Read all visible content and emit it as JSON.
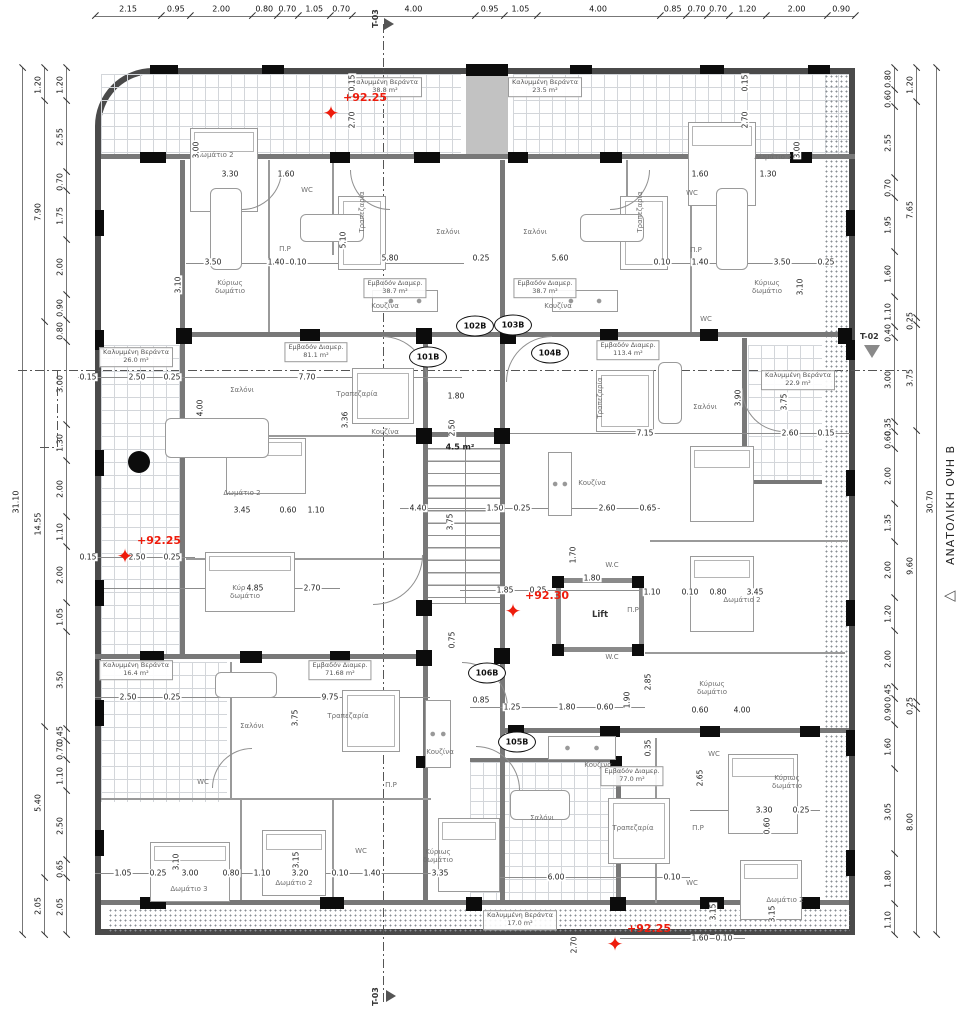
{
  "colors": {
    "elevation_red": "#ee1c0c",
    "wall_gray": "#787878",
    "wall_black": "#0c0c0c",
    "tile_grid": "#d3d6da"
  },
  "side_title": {
    "text": "ΑΝΑΤΟΛΙΚΗ ΟΨΗ Β",
    "triangle": "◁"
  },
  "section_markers": {
    "top": "T-03",
    "bottom": "T-03",
    "right": "T-02"
  },
  "core_labels": {
    "lift": "Lift"
  },
  "dims": {
    "top": [
      "2.15",
      "0.95",
      "2.00",
      "0.80",
      "0.70",
      "1.05",
      "0.70",
      "4.00",
      "0.95",
      "1.05",
      "4.00",
      "0.85",
      "0.70",
      "0.70",
      "1.20",
      "2.00",
      "0.90"
    ],
    "left_total": [
      "31.10"
    ],
    "left_outer": [
      "1.20",
      "7.90",
      "14.55",
      "5.40",
      "2.05"
    ],
    "left_inner": [
      "1.20",
      "2.55",
      "0.70",
      "1.75",
      "2.00",
      "0.90",
      "0.80",
      "3.00",
      "1.30",
      "2.00",
      "1.10",
      "2.00",
      "1.05",
      "3.50",
      "0.45",
      "0.70",
      "1.10",
      "2.50",
      "0.65",
      "2.05"
    ],
    "right_inner": [
      "0.80",
      "0.60",
      "2.55",
      "0.70",
      "1.95",
      "1.60",
      "1.10",
      "0.40",
      "3.00",
      "0.35",
      "0.60",
      "2.00",
      "1.35",
      "2.00",
      "1.20",
      "2.00",
      "0.45",
      "0.90",
      "1.60",
      "3.05",
      "1.80",
      "1.10"
    ],
    "right_outer": [
      "1.20",
      "7.65",
      "0.25",
      "3.75",
      "9.60",
      "0.25",
      "8.00"
    ],
    "right_total": [
      "30.70"
    ]
  },
  "elevation_markers": [
    {
      "label": "+92.25",
      "x": 331,
      "y": 113
    },
    {
      "label": "+92.25",
      "x": 125,
      "y": 556
    },
    {
      "label": "+92.30",
      "x": 513,
      "y": 611
    },
    {
      "label": "+92.25",
      "x": 615,
      "y": 944
    }
  ],
  "unit_tags": [
    {
      "label": "101B",
      "x": 428,
      "y": 357
    },
    {
      "label": "102B",
      "x": 475,
      "y": 326
    },
    {
      "label": "103B",
      "x": 513,
      "y": 325
    },
    {
      "label": "104B",
      "x": 550,
      "y": 353
    },
    {
      "label": "106B",
      "x": 487,
      "y": 673
    },
    {
      "label": "105B",
      "x": 517,
      "y": 742
    }
  ],
  "area_labels": [
    {
      "name": "Καλυμμένη Βεράντα",
      "value": "38.8 m²",
      "x": 385,
      "y": 87
    },
    {
      "name": "Καλυμμένη Βεράντα",
      "value": "23.5 m²",
      "x": 545,
      "y": 87
    },
    {
      "name": "Εμβαδόν Διαμερ.",
      "value": "38.7 m²",
      "x": 395,
      "y": 288
    },
    {
      "name": "Εμβαδόν Διαμερ.",
      "value": "38.7 m²",
      "x": 545,
      "y": 288
    },
    {
      "name": "Εμβαδόν Διαμερ.",
      "value": "81.1 m²",
      "x": 316,
      "y": 352
    },
    {
      "name": "Καλυμμένη Βεράντα",
      "value": "26.0 m²",
      "x": 136,
      "y": 357
    },
    {
      "name": "Εμβαδόν Διαμερ.",
      "value": "113.4 m²",
      "x": 628,
      "y": 350
    },
    {
      "name": "Καλυμμένη Βεράντα",
      "value": "22.9 m²",
      "x": 798,
      "y": 380
    },
    {
      "name": "Καλυμμένη Βεράντα",
      "value": "16.4 m²",
      "x": 136,
      "y": 670
    },
    {
      "name": "Εμβαδόν Διαμερ.",
      "value": "71.68 m²",
      "x": 340,
      "y": 670
    },
    {
      "name": "Εμβαδόν Διαμερ.",
      "value": "77.0 m²",
      "x": 632,
      "y": 776
    },
    {
      "name": "Καλυμμένη Βεράντα",
      "value": "17.0 m²",
      "x": 520,
      "y": 920
    }
  ],
  "room_labels": [
    {
      "t": "Σαλόνι",
      "x": 448,
      "y": 232
    },
    {
      "t": "Σαλόνι",
      "x": 535,
      "y": 232
    },
    {
      "t": "Σαλόνι",
      "x": 242,
      "y": 390
    },
    {
      "t": "Σαλόνι",
      "x": 705,
      "y": 407
    },
    {
      "t": "Σαλόνι",
      "x": 252,
      "y": 726
    },
    {
      "t": "Σαλόνι",
      "x": 542,
      "y": 818
    },
    {
      "t": "Τραπεζαρία",
      "x": 362,
      "y": 212,
      "r": 1
    },
    {
      "t": "Τραπεζαρία",
      "x": 640,
      "y": 212,
      "r": 1
    },
    {
      "t": "Τραπεζαρία",
      "x": 357,
      "y": 394
    },
    {
      "t": "Τραπεζαρία",
      "x": 600,
      "y": 398,
      "r": 1
    },
    {
      "t": "Τραπεζαρία",
      "x": 348,
      "y": 716
    },
    {
      "t": "Τραπεζαρία",
      "x": 633,
      "y": 828
    },
    {
      "t": "Κουζίνα",
      "x": 385,
      "y": 306
    },
    {
      "t": "Κουζίνα",
      "x": 558,
      "y": 306
    },
    {
      "t": "Κουζίνα",
      "x": 385,
      "y": 432
    },
    {
      "t": "Κουζίνα",
      "x": 592,
      "y": 483
    },
    {
      "t": "Κουζίνα",
      "x": 440,
      "y": 752
    },
    {
      "t": "Κουζίνα",
      "x": 598,
      "y": 765
    },
    {
      "t": "WC",
      "x": 307,
      "y": 190
    },
    {
      "t": "WC",
      "x": 692,
      "y": 193
    },
    {
      "t": "WC",
      "x": 706,
      "y": 319
    },
    {
      "t": "W.C",
      "x": 612,
      "y": 565
    },
    {
      "t": "W.C",
      "x": 612,
      "y": 657
    },
    {
      "t": "WC",
      "x": 203,
      "y": 782
    },
    {
      "t": "WC",
      "x": 714,
      "y": 754
    },
    {
      "t": "WC",
      "x": 692,
      "y": 883
    },
    {
      "t": "WC",
      "x": 361,
      "y": 851
    },
    {
      "t": "Π.Ρ",
      "x": 285,
      "y": 249
    },
    {
      "t": "Π.Ρ",
      "x": 696,
      "y": 250
    },
    {
      "t": "Π.Ρ",
      "x": 633,
      "y": 610
    },
    {
      "t": "Π.Ρ",
      "x": 391,
      "y": 785
    },
    {
      "t": "Π.Ρ",
      "x": 698,
      "y": 828
    },
    {
      "t": "Κύριως δωμάτιο",
      "x": 230,
      "y": 287,
      "w": 1
    },
    {
      "t": "Κύριως δωμάτιο",
      "x": 767,
      "y": 287,
      "w": 1
    },
    {
      "t": "Κύριως δωμάτιο",
      "x": 245,
      "y": 592,
      "w": 1
    },
    {
      "t": "Κύριως δωμάτιο",
      "x": 712,
      "y": 688,
      "w": 1
    },
    {
      "t": "Κύριως δωμάτιο",
      "x": 787,
      "y": 782,
      "w": 1
    },
    {
      "t": "Κύριως δωμάτιο",
      "x": 438,
      "y": 856,
      "w": 1
    },
    {
      "t": "Δωμάτιο 2",
      "x": 215,
      "y": 155
    },
    {
      "t": "Δωμάτιο 2",
      "x": 773,
      "y": 157
    },
    {
      "t": "Δωμάτιο 2",
      "x": 242,
      "y": 493
    },
    {
      "t": "Δωμάτιο 2",
      "x": 742,
      "y": 600
    },
    {
      "t": "Δωμάτιο 2",
      "x": 294,
      "y": 883
    },
    {
      "t": "Δωμάτιο 2",
      "x": 785,
      "y": 900
    },
    {
      "t": "Δωμάτιο 3",
      "x": 189,
      "y": 889
    },
    {
      "t": "4.5 m²",
      "x": 460,
      "y": 447,
      "b": 1
    }
  ],
  "dim_texts": [
    [
      "3.30",
      230,
      174
    ],
    [
      "1.60",
      286,
      174
    ],
    [
      "1.60",
      700,
      174
    ],
    [
      "1.30",
      768,
      174
    ],
    [
      "3.00",
      196,
      150,
      1
    ],
    [
      "3.00",
      797,
      150,
      1
    ],
    [
      "2.70",
      352,
      120,
      1
    ],
    [
      "0.15",
      352,
      83,
      1
    ],
    [
      "2.70",
      745,
      120,
      1
    ],
    [
      "0.15",
      745,
      83,
      1
    ],
    [
      "5.10",
      343,
      240,
      1
    ],
    [
      "3.50",
      213,
      262
    ],
    [
      "1.40",
      276,
      262
    ],
    [
      "0.10",
      298,
      262
    ],
    [
      "5.80",
      390,
      258
    ],
    [
      "0.25",
      481,
      258
    ],
    [
      "5.60",
      560,
      258
    ],
    [
      "0.10",
      662,
      262
    ],
    [
      "1.40",
      700,
      262
    ],
    [
      "3.50",
      782,
      262
    ],
    [
      "0.25",
      826,
      262
    ],
    [
      "3.10",
      178,
      285,
      1
    ],
    [
      "3.10",
      800,
      287,
      1
    ],
    [
      "0.15",
      88,
      377
    ],
    [
      "2.50",
      137,
      377
    ],
    [
      "0.25",
      172,
      377
    ],
    [
      "7.70",
      307,
      377
    ],
    [
      "4.00",
      200,
      408,
      1
    ],
    [
      "3.36",
      345,
      420,
      1
    ],
    [
      "1.80",
      456,
      396
    ],
    [
      "2.50",
      452,
      428,
      1
    ],
    [
      "3.90",
      738,
      398,
      1
    ],
    [
      "3.75",
      784,
      402,
      1
    ],
    [
      "7.15",
      645,
      433
    ],
    [
      "2.60",
      790,
      433
    ],
    [
      "0.15",
      826,
      433
    ],
    [
      "3.45",
      242,
      510
    ],
    [
      "0.60",
      288,
      510
    ],
    [
      "1.10",
      316,
      510
    ],
    [
      "0.15",
      88,
      557
    ],
    [
      "2.50",
      137,
      557
    ],
    [
      "0.25",
      172,
      557
    ],
    [
      "4.85",
      255,
      588
    ],
    [
      "2.70",
      312,
      588
    ],
    [
      "4.40",
      418,
      508
    ],
    [
      "1.50",
      495,
      508
    ],
    [
      "0.25",
      522,
      508
    ],
    [
      "2.60",
      607,
      508
    ],
    [
      "0.65",
      648,
      508
    ],
    [
      "3.75",
      450,
      522,
      1
    ],
    [
      "0.75",
      452,
      640,
      1
    ],
    [
      "1.70",
      573,
      555,
      1
    ],
    [
      "1.85",
      505,
      590
    ],
    [
      "0.25",
      538,
      590
    ],
    [
      "1.80",
      592,
      578
    ],
    [
      "1.10",
      652,
      592
    ],
    [
      "0.10",
      690,
      592
    ],
    [
      "0.80",
      718,
      592
    ],
    [
      "3.45",
      755,
      592
    ],
    [
      "2.50",
      128,
      697
    ],
    [
      "0.25",
      172,
      697
    ],
    [
      "9.75",
      330,
      697
    ],
    [
      "3.75",
      295,
      718,
      1
    ],
    [
      "0.85",
      481,
      700
    ],
    [
      "1.25",
      512,
      707
    ],
    [
      "1.80",
      567,
      707
    ],
    [
      "0.60",
      605,
      707
    ],
    [
      "1.90",
      627,
      700,
      1
    ],
    [
      "2.85",
      648,
      682,
      1
    ],
    [
      "0.35",
      648,
      748,
      1
    ],
    [
      "0.60",
      700,
      710
    ],
    [
      "4.00",
      742,
      710
    ],
    [
      "1.05",
      123,
      873
    ],
    [
      "0.25",
      158,
      873
    ],
    [
      "3.00",
      190,
      873
    ],
    [
      "0.80",
      231,
      873
    ],
    [
      "1.10",
      262,
      873
    ],
    [
      "3.20",
      300,
      873
    ],
    [
      "0.10",
      340,
      873
    ],
    [
      "1.40",
      372,
      873
    ],
    [
      "3.35",
      440,
      873
    ],
    [
      "3.10",
      176,
      862,
      1
    ],
    [
      "3.15",
      296,
      860,
      1
    ],
    [
      "6.00",
      556,
      877
    ],
    [
      "0.10",
      672,
      877
    ],
    [
      "2.70",
      574,
      945,
      1
    ],
    [
      "1.60",
      700,
      938
    ],
    [
      "0.10",
      724,
      938
    ],
    [
      "3.15",
      713,
      912,
      1
    ],
    [
      "3.30",
      764,
      810
    ],
    [
      "0.25",
      801,
      810
    ],
    [
      "2.65",
      700,
      778,
      1
    ],
    [
      "0.60",
      767,
      826,
      1
    ],
    [
      "3.15",
      772,
      914,
      1
    ]
  ]
}
